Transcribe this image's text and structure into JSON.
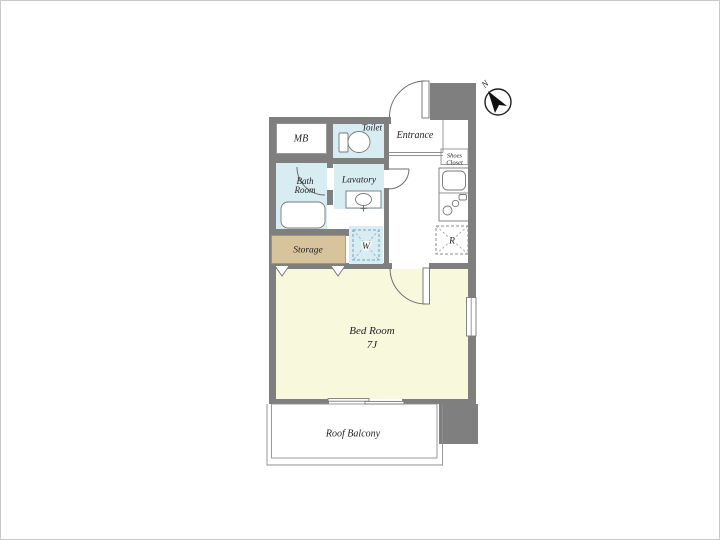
{
  "plan": {
    "type": "apartment-floor-plan",
    "compass": {
      "label": "N"
    },
    "colors": {
      "wall": "#7f7f7f",
      "wet_room_floor": "#d8edf2",
      "bedroom_floor": "#f8f8dd",
      "storage_floor": "#d8c49c",
      "balcony_floor": "#ffffff",
      "outline": "#909090",
      "text": "#1f1f1f",
      "washer_dash": "#6f9fb8"
    },
    "rooms": {
      "mb": {
        "label": "MB"
      },
      "toilet": {
        "label": "Toilet"
      },
      "entrance": {
        "label": "Entrance"
      },
      "shoes_closet": {
        "label_line1": "Shoes",
        "label_line2": "Closet"
      },
      "bath_room": {
        "label_line1": "Bath",
        "label_line2": "Room"
      },
      "lavatory": {
        "label": "Lavatory"
      },
      "storage": {
        "label": "Storage"
      },
      "washing_machine": {
        "label": "W"
      },
      "refrigerator": {
        "label": "R"
      },
      "bed_room": {
        "label": "Bed Room",
        "size": "7J"
      },
      "roof_balcony": {
        "label": "Roof Balcony"
      }
    }
  }
}
